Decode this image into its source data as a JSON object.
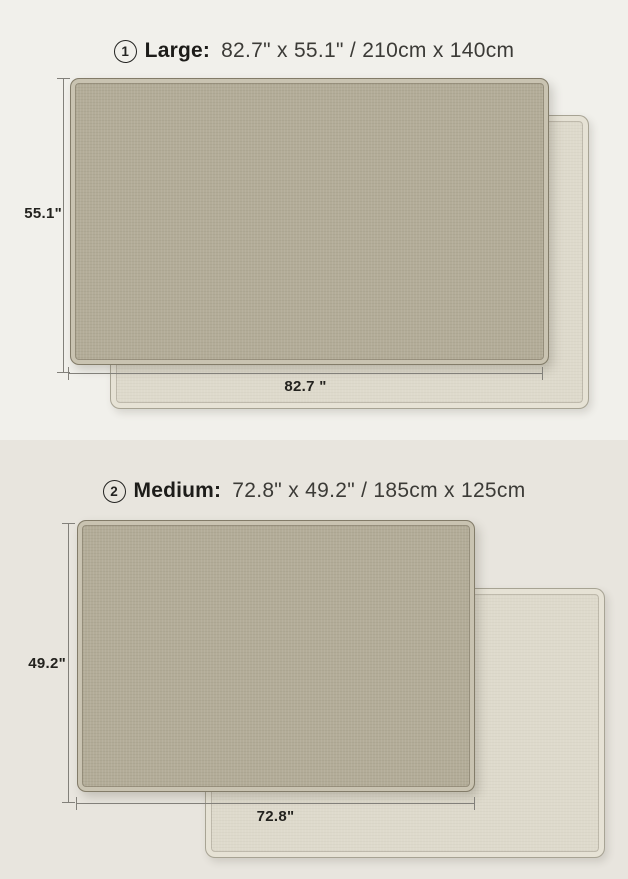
{
  "title": "Rug size comparison diagram",
  "colors": {
    "bg_top": "#f1f0eb",
    "bg_bottom": "#e8e5de",
    "mat_front": "#b3ac98",
    "mat_back": "#dedacc",
    "dim_line": "#82807a",
    "text_dark": "#1f1e1b"
  },
  "sections": [
    {
      "badge": "1",
      "name": "Large:",
      "dimensions": "82.7\" x 55.1\" / 210cm x 140cm",
      "height_label": "55.1\"",
      "width_label": "82.7 \"",
      "front_mat": "rug front side (taupe)",
      "back_mat": "rug back side (cream)"
    },
    {
      "badge": "2",
      "name": "Medium:",
      "dimensions": "72.8\" x 49.2\" / 185cm x 125cm",
      "height_label": "49.2\"",
      "width_label": "72.8\"",
      "front_mat": "rug front side (taupe)",
      "back_mat": "rug back side (cream)"
    }
  ]
}
